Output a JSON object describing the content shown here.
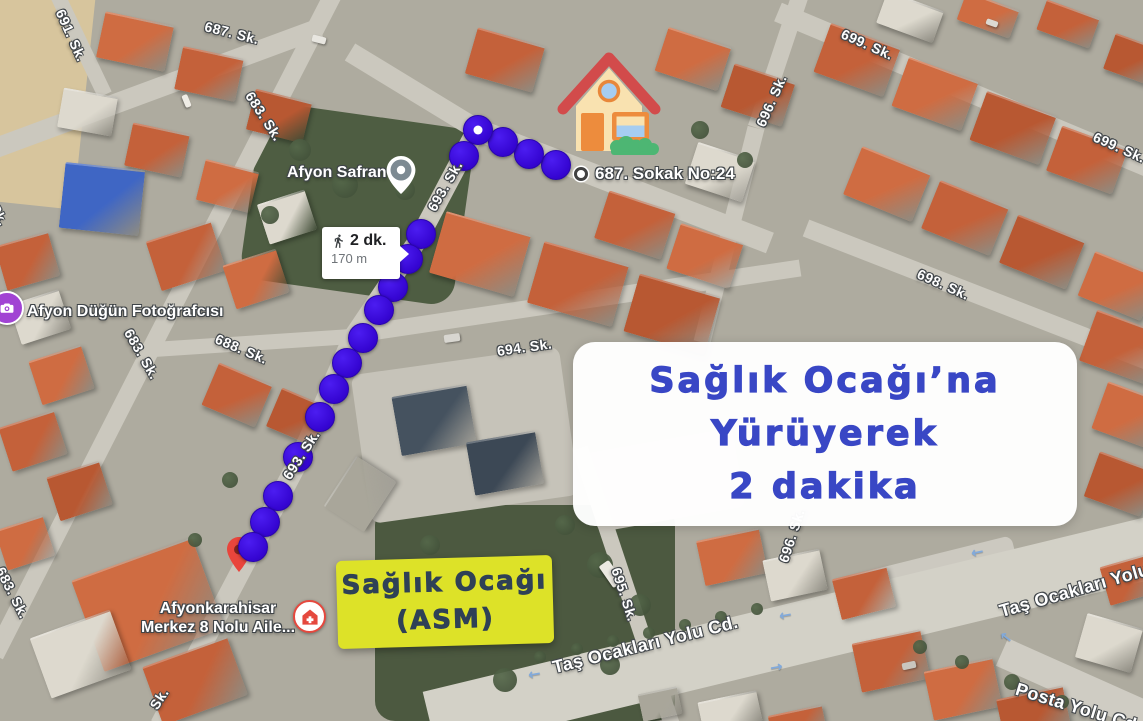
{
  "map": {
    "streets": [
      {
        "text": "691. Sk."
      },
      {
        "text": "687. Sk."
      },
      {
        "text": "683. Sk."
      },
      {
        "text": "Sk."
      },
      {
        "text": "693. Sk."
      },
      {
        "text": "688. Sk."
      },
      {
        "text": "683. Sk."
      },
      {
        "text": "694. Sk."
      },
      {
        "text": "693. Sk."
      },
      {
        "text": "683. Sk."
      },
      {
        "text": "Sk."
      },
      {
        "text": "695. Sk."
      },
      {
        "text": "696. Sk."
      },
      {
        "text": "699. Sk."
      },
      {
        "text": "699. Sk."
      },
      {
        "text": "698. Sk."
      },
      {
        "text": "Taş Ocakları Yolu Cd."
      },
      {
        "text": "Taş Ocakları Yolu"
      },
      {
        "text": "Posta Yolu Cd."
      },
      {
        "text": "696. Sk."
      }
    ],
    "pois": {
      "safran": {
        "label": "Afyon Safran"
      },
      "sokak24": {
        "label": "687. Sokak No:24"
      },
      "dugun": {
        "label": "Afyon Düğün Fotoğrafcısı"
      },
      "asm": {
        "line1": "Afyonkarahisar",
        "line2": "Merkez 8 Nolu Aile..."
      }
    }
  },
  "walk_bubble": {
    "time": "2 dk.",
    "distance": "170 m"
  },
  "banner": {
    "line1": "Sağlık Ocağı’na",
    "line2": "Yürüyerek",
    "line3": "2 dakika"
  },
  "dest_tag": {
    "line1": "Sağlık Ocağı",
    "line2": "(ASM)"
  },
  "icons": {
    "house": "house-icon",
    "walking": "walking-person-icon",
    "route_start": "route-start-dot",
    "destination_pin": "destination-pin-icon",
    "safran_marker": "location-marker-icon",
    "photo_studio": "camera-icon",
    "health_center": "health-center-icon",
    "address_dot": "poi-dot-icon",
    "traffic_arrows": "direction-arrow-icon"
  },
  "colors": {
    "route_dot": "#3505d2",
    "banner_text": "#3947c5",
    "banner_bg": "#ffffff",
    "tag_bg": "#dde228",
    "tag_text": "#2f4156",
    "pin_red": "#e8453c"
  }
}
